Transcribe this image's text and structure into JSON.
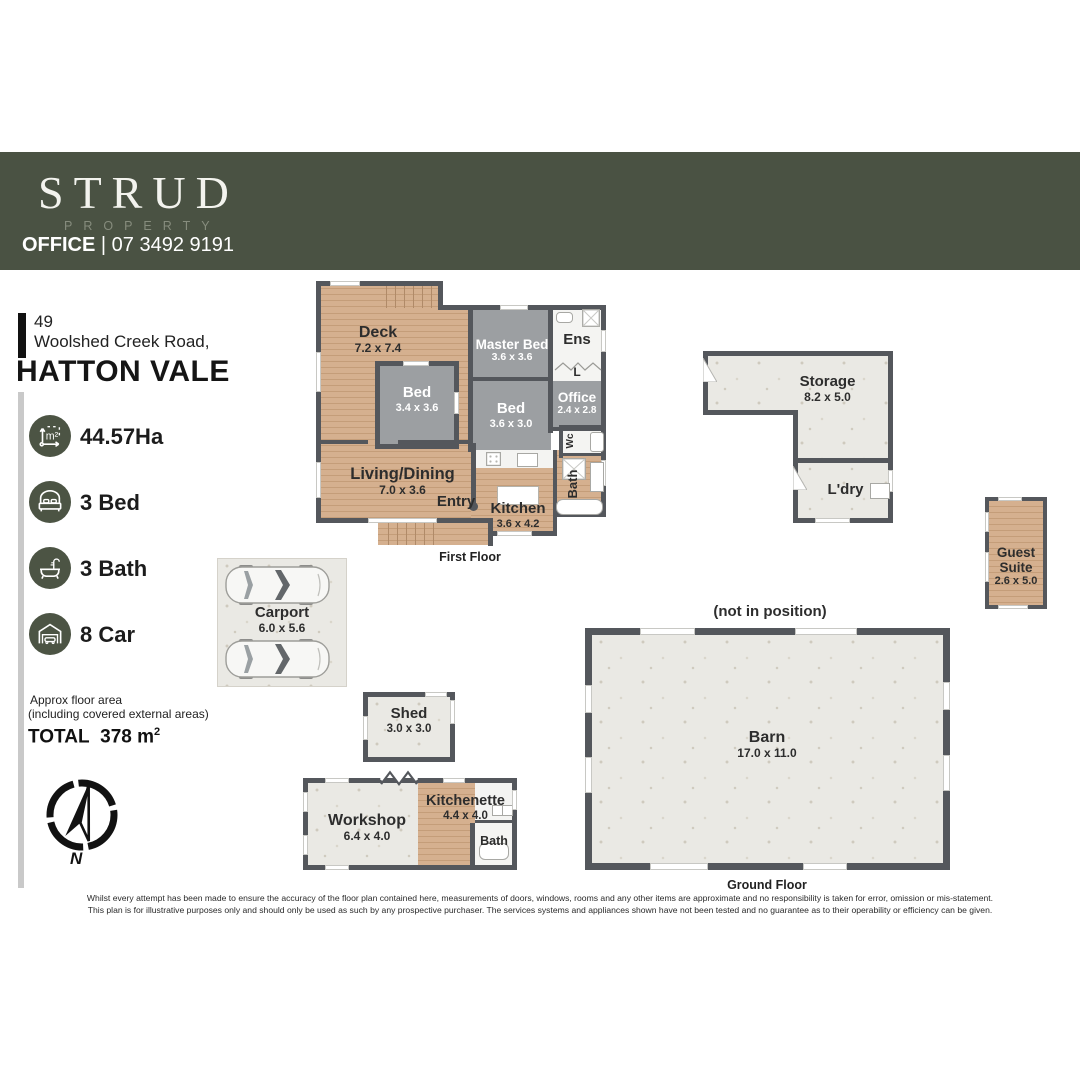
{
  "header": {
    "brand": "STRUD",
    "brand_subtitle": "PROPERTY",
    "office_label": "OFFICE",
    "office_phone": "| 07 3492 9191"
  },
  "address": {
    "street_number": "49",
    "street_name": "Woolshed Creek Road,",
    "suburb": "HATTON VALE"
  },
  "stats": {
    "land_size": {
      "icon": "land-size-icon",
      "icon_text": "m²",
      "value": "44.57Ha"
    },
    "beds": {
      "icon": "bed-icon",
      "value": "3 Bed"
    },
    "baths": {
      "icon": "bath-icon",
      "value": "3 Bath"
    },
    "cars": {
      "icon": "garage-icon",
      "value": "8 Car"
    }
  },
  "floor_area": {
    "note_line1": "Approx floor area",
    "note_line2": "(including covered external areas)",
    "total_label": "TOTAL",
    "total_value": "378 m",
    "total_superscript": "2"
  },
  "compass": {
    "north_label": "N"
  },
  "first_floor": {
    "caption": "First Floor",
    "rooms": {
      "deck": {
        "name": "Deck",
        "dims": "7.2 x 7.4"
      },
      "master_bed": {
        "name": "Master Bed",
        "dims": "3.6 x 3.6"
      },
      "ens": {
        "name": "Ens"
      },
      "linen": {
        "name": "L"
      },
      "bed_small": {
        "name": "Bed",
        "dims": "3.4 x 3.6"
      },
      "bed": {
        "name": "Bed",
        "dims": "3.6 x 3.0"
      },
      "office": {
        "name": "Office",
        "dims": "2.4 x 2.8"
      },
      "living_dining": {
        "name": "Living/Dining",
        "dims": "7.0 x 3.6"
      },
      "entry": {
        "name": "Entry"
      },
      "kitchen": {
        "name": "Kitchen",
        "dims": "3.6 x 4.2"
      },
      "wc": {
        "name": "Wc"
      },
      "bath": {
        "name": "Bath"
      }
    }
  },
  "ground_floor": {
    "caption": "Ground Floor",
    "barn_note": "(not in position)",
    "rooms": {
      "storage": {
        "name": "Storage",
        "dims": "8.2 x 5.0"
      },
      "laundry": {
        "name": "L'dry"
      },
      "guest_suite": {
        "name": "Guest Suite",
        "dims": "2.6 x 5.0"
      },
      "carport": {
        "name": "Carport",
        "dims": "6.0 x 5.6"
      },
      "shed": {
        "name": "Shed",
        "dims": "3.0 x 3.0"
      },
      "barn": {
        "name": "Barn",
        "dims": "17.0 x 11.0"
      },
      "workshop": {
        "name": "Workshop",
        "dims": "6.4 x 4.0"
      },
      "kitchenette": {
        "name": "Kitchenette",
        "dims": "4.4 x 4.0"
      },
      "bath": {
        "name": "Bath"
      }
    }
  },
  "disclaimer": {
    "line1": "Whilst every attempt has been made to ensure the accuracy of the floor plan contained here, measurements of doors, windows, rooms and any other items are approximate and no responsibility is taken for error, omission or mis-statement.",
    "line2": "This plan is for illustrative purposes only and should only be used as such by any prospective purchaser. The services systems and appliances shown have not been tested and no guarantee as to their operability or efficiency can be given."
  },
  "colors": {
    "header_band": "#4a5243",
    "icon_circle": "#4c5444",
    "wall": "#54575c",
    "room_gray": "#9c9fa2",
    "wood": "#d5b08f",
    "concrete": "#eae9e4"
  }
}
